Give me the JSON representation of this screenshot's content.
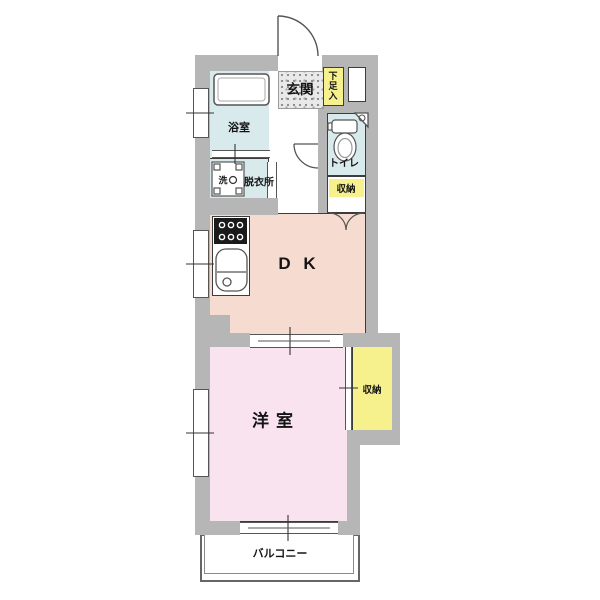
{
  "floorplan": {
    "rooms": {
      "entrance": {
        "label": "玄関"
      },
      "shoe_cabinet": {
        "label": "下足入"
      },
      "bathroom": {
        "label": "浴室"
      },
      "washing_machine": {
        "label": "洗"
      },
      "dressing_room": {
        "label": "脱衣所"
      },
      "toilet": {
        "label": "トイレ"
      },
      "hall_storage": {
        "label": "収納"
      },
      "dining_kitchen": {
        "label": "D K"
      },
      "western_room": {
        "label": "洋室"
      },
      "bedroom_storage": {
        "label": "収納"
      },
      "balcony": {
        "label": "バルコニー"
      }
    },
    "colors": {
      "wall": "#b6b6b6",
      "wet_area": "#d9eaed",
      "dining_kitchen_floor": "#f6dbd0",
      "western_room_floor": "#f8e3ef",
      "storage_fill": "#f6f08d",
      "outline": "#3c3c3c"
    }
  }
}
